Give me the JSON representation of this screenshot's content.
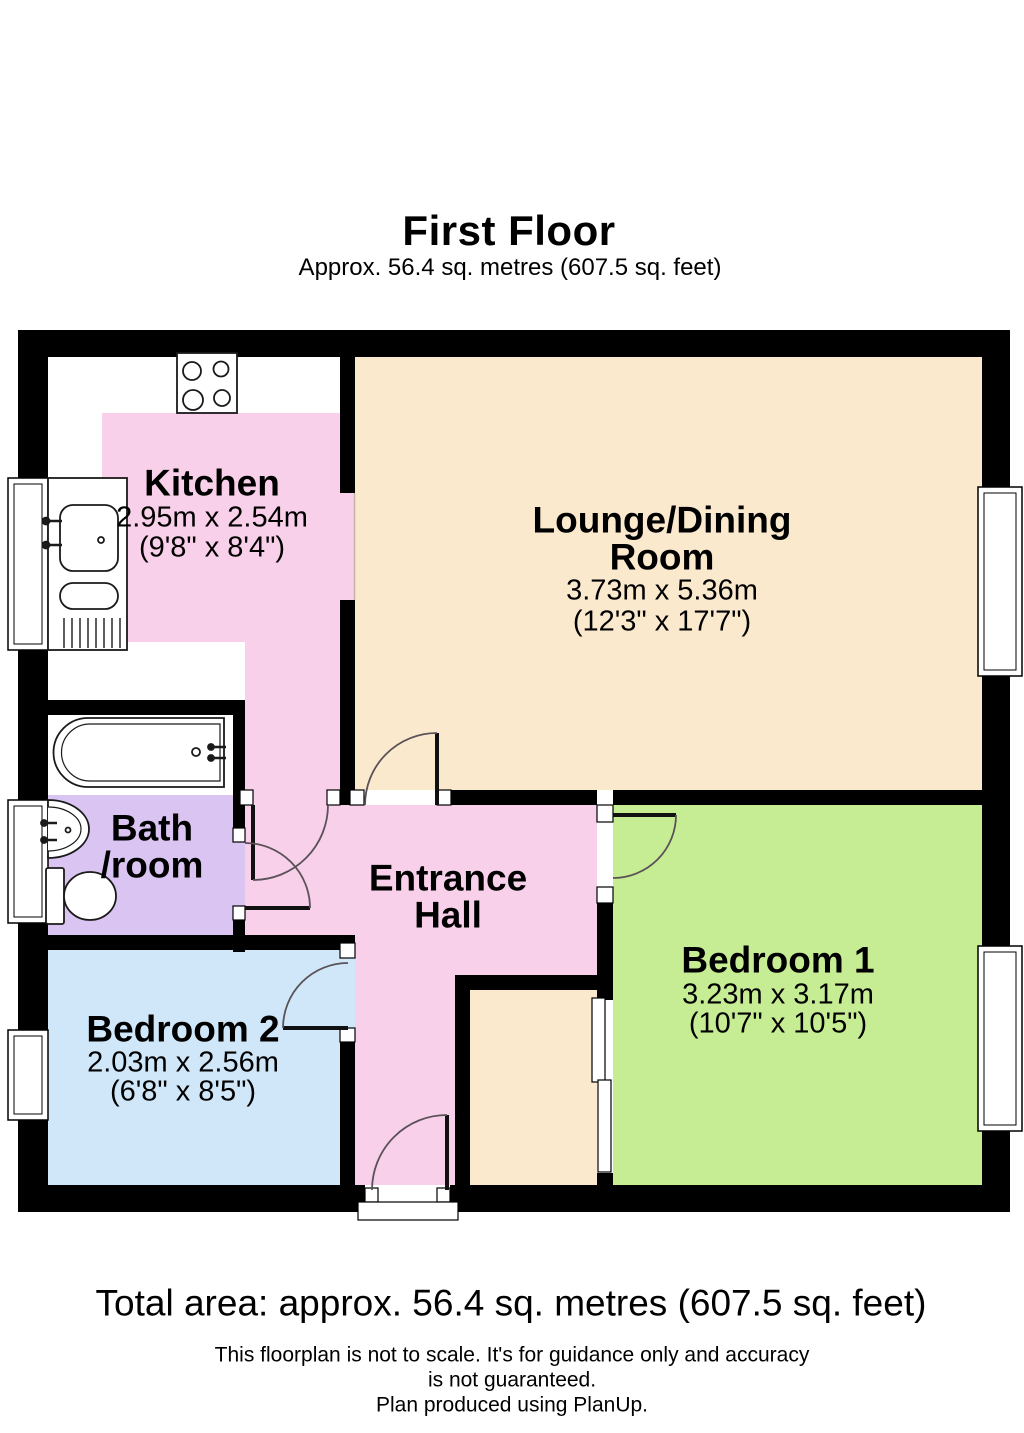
{
  "header": {
    "title": "First Floor",
    "subtitle": "Approx. 56.4 sq. metres (607.5 sq. feet)"
  },
  "rooms": {
    "kitchen": {
      "name": "Kitchen",
      "dim_metric": "2.95m x 2.54m",
      "dim_imperial": "(9'8\" x 8'4\")"
    },
    "lounge": {
      "name_line1": "Lounge/Dining",
      "name_line2": "Room",
      "dim_metric": "3.73m x 5.36m",
      "dim_imperial": "(12'3\" x 17'7\")"
    },
    "bathroom": {
      "name_line1": "Bath",
      "name_line2": "/room"
    },
    "hall": {
      "name_line1": "Entrance",
      "name_line2": "Hall"
    },
    "bedroom1": {
      "name": "Bedroom 1",
      "dim_metric": "3.23m x 3.17m",
      "dim_imperial": "(10'7\" x 10'5\")"
    },
    "bedroom2": {
      "name": "Bedroom 2",
      "dim_metric": "2.03m x 2.56m",
      "dim_imperial": "(6'8\" x 8'5\")"
    }
  },
  "footer": {
    "total_area": "Total area: approx. 56.4 sq. metres (607.5 sq. feet)",
    "disclaimer_line1": "This floorplan is not to scale. It's for guidance only and accuracy",
    "disclaimer_line2": "is not guaranteed.",
    "disclaimer_line3": "Plan produced using PlanUp."
  },
  "colors": {
    "walls": "#000000",
    "kitchen_pink": "#F8D0E9",
    "hall_pink": "#F8D0E9",
    "lounge_cream": "#FBE9CE",
    "cupboard_cream": "#FBE9CE",
    "bathroom_purple": "#D9C4F2",
    "bedroom1_green": "#C6ED94",
    "bedroom2_blue": "#CFE7F9",
    "fixture_white": "#FFFFFF"
  }
}
